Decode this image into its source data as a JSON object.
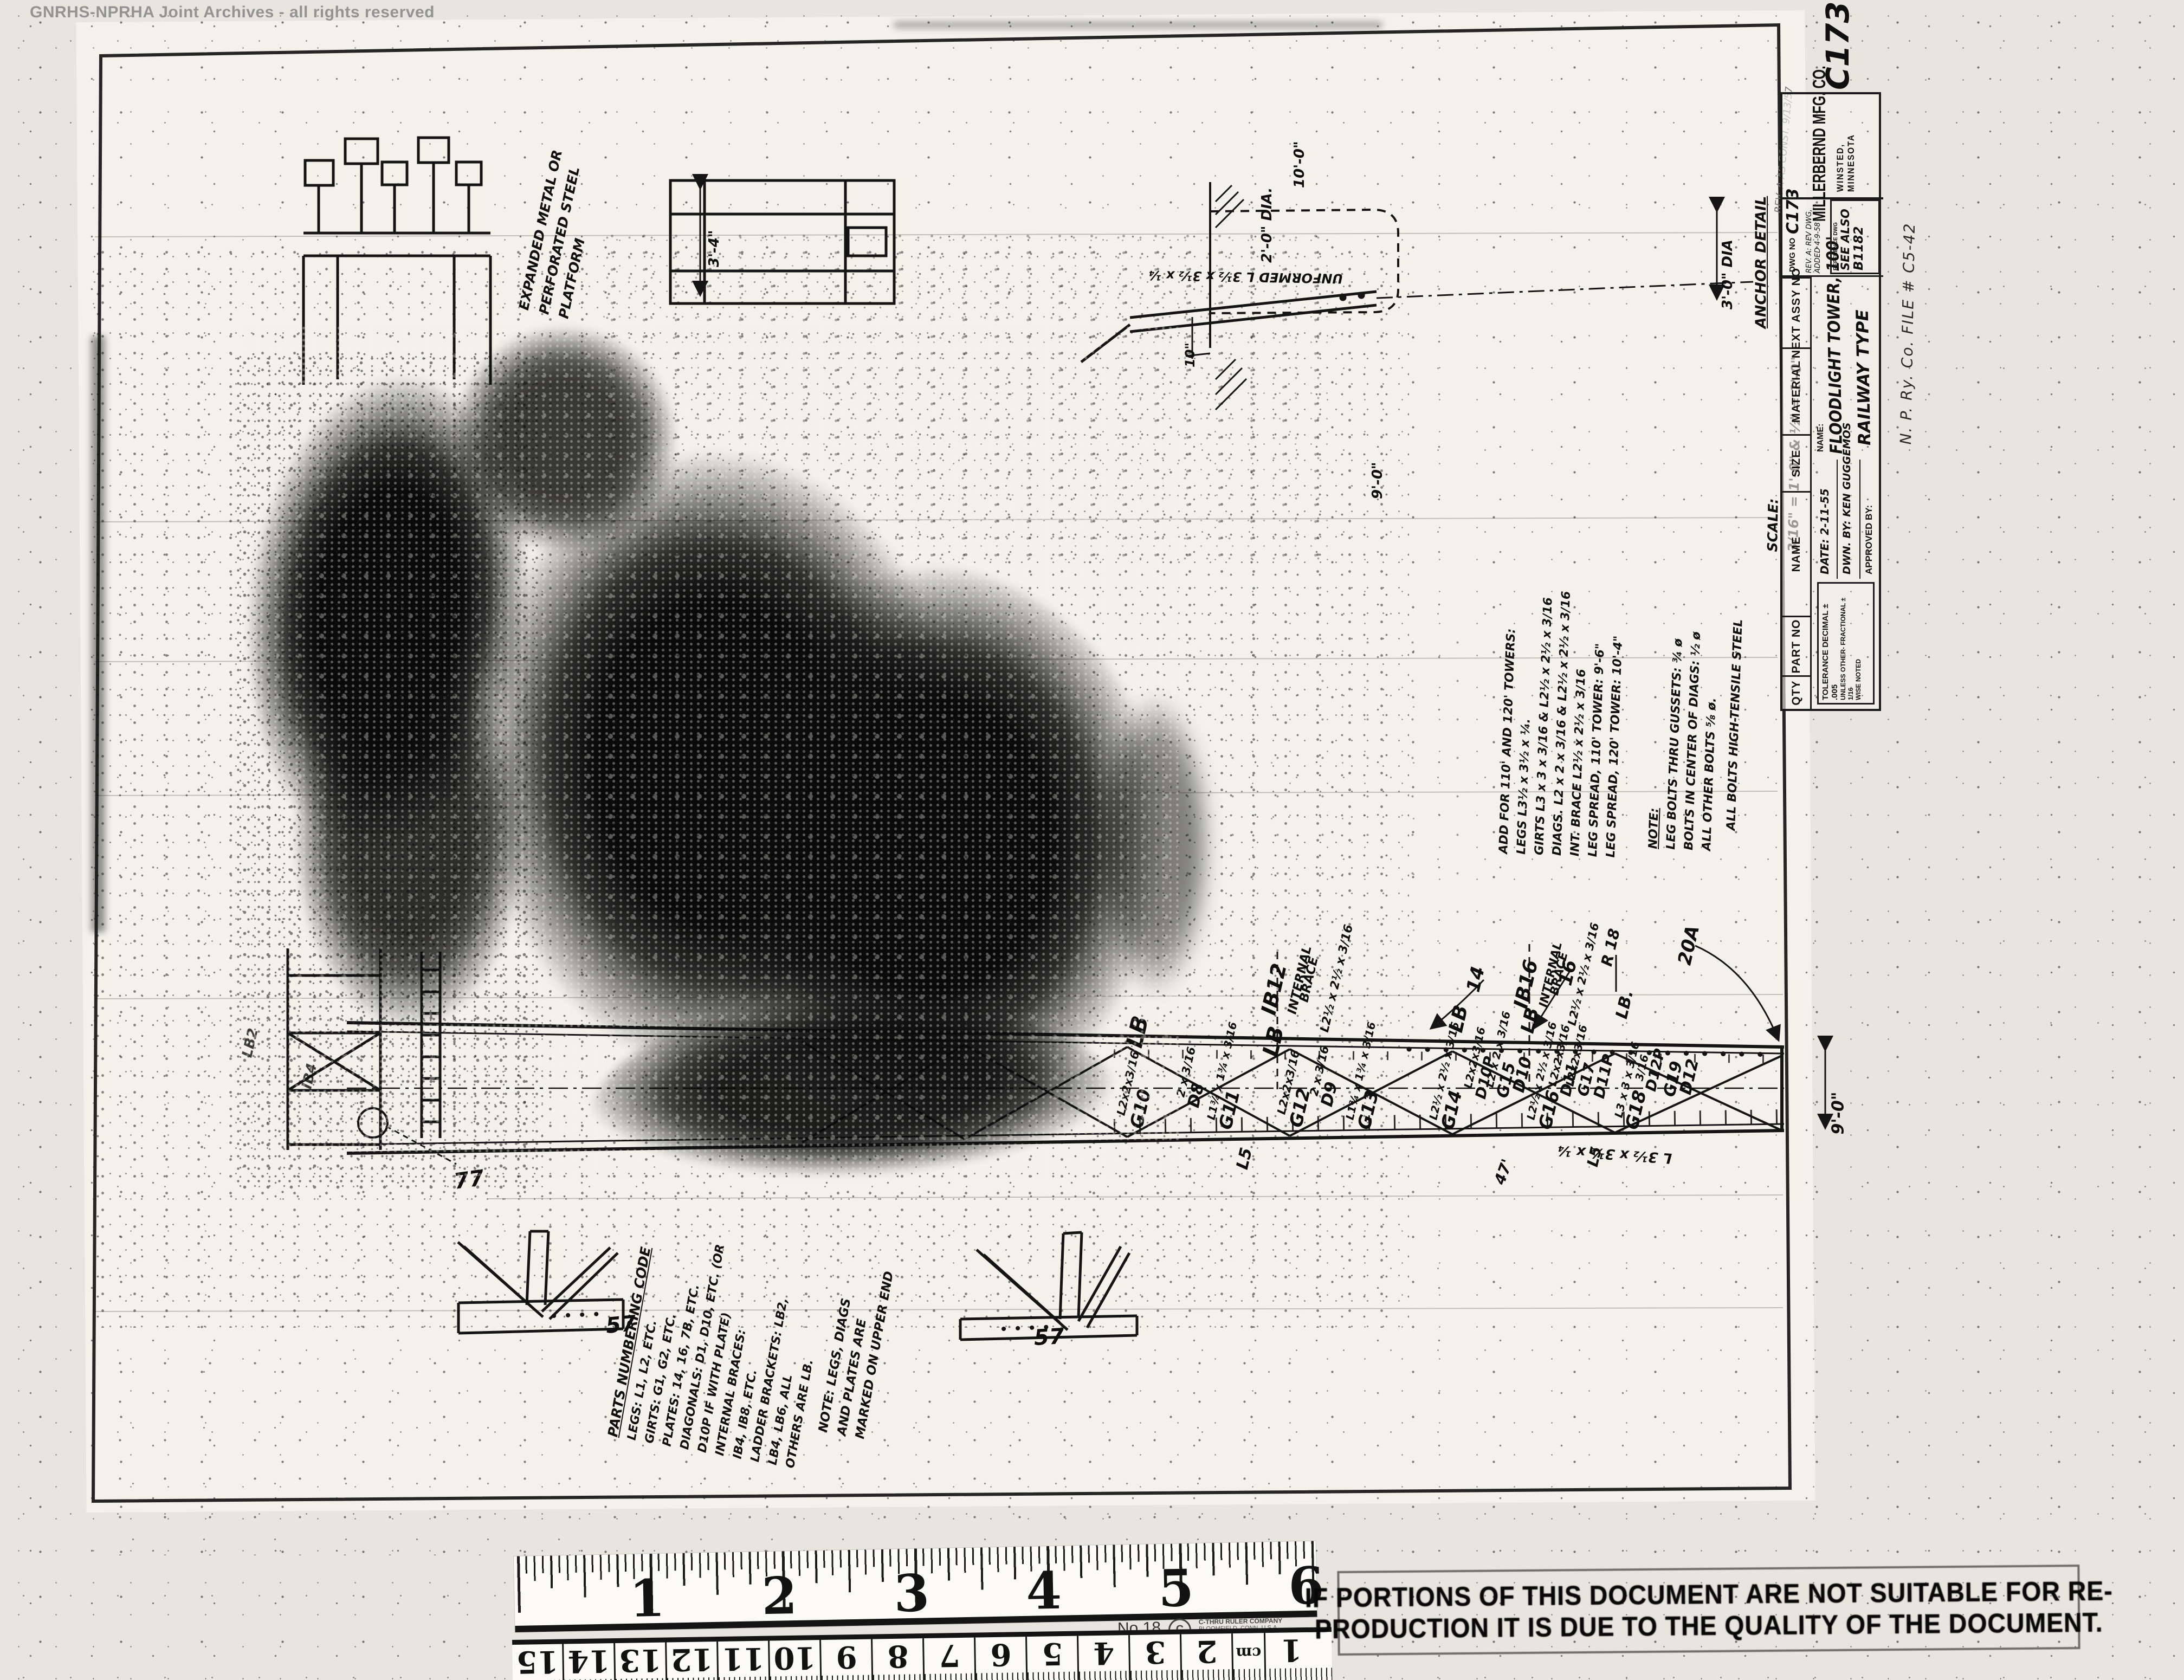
{
  "watermark": "GNRHS-NPRHA Joint Archives - all rights reserved",
  "title_block": {
    "sheet_no": "C173",
    "headers": {
      "qty": "QTY",
      "part_no": "PART NO",
      "name": "NAME",
      "size": "SIZE",
      "material": "MATERIAL",
      "next_assy": "NEXT ASSY NO"
    },
    "tolerance": {
      "l1": "TOLERANCE  DECIMAL ± .005",
      "l2": "UNLESS OTHER-  FRACTIONAL ± 1/16",
      "l3": "WISE NOTED"
    },
    "date": "DATE: 2-11-55",
    "drawn_by": "DWN. BY:  KEN GUGGEMOS",
    "approved_by": "APPROVED BY:",
    "name_label": "NAME:",
    "name_value_1": "FLOODLIGHT TOWER, 100'",
    "name_value_2": "RAILWAY TYPE",
    "dwg_no_label": "DWG NO",
    "dwg_no_value": "C173",
    "rev_note": "REV. A: REV DWG, ADDED 4-9-58",
    "reference_label": "REFERENCE DWG",
    "reference_value_1": "SEE ALSO",
    "reference_value_2": "B1182",
    "company": "MILLERBERND MFG. CO.",
    "company_city": "WINSTED, MINNESOTA",
    "file_note": "N. P. Ry. Co.    FILE  # C5-42",
    "scale_1": "SCALE:",
    "scale_2": "3/16\" = 1'-0\"  &  ½\" = 1'-0\""
  },
  "anchor_detail": {
    "title": "ANCHOR DETAIL",
    "rev_note": "REV. A  AS CONST. 9/13/57",
    "dim_dia_small": "2'-0\" DIA.",
    "dim_depth": "10'-0\"",
    "dim_stub": "10\"",
    "dim_spread": "9'-0\"",
    "dim_dia_big": "3'-0\" DIA",
    "leg_label": "UNFORMED  L 3½ x 3½ x ¼"
  },
  "platform": {
    "dim": "3'-4\"",
    "note_1": "EXPANDED METAL OR",
    "note_2": "PERFORATED STEEL",
    "note_3": "PLATFORM"
  },
  "notes_add": {
    "lines": [
      "ADD FOR 110' AND 120' TOWERS:",
      "LEGS  L3½ x 3½ x ¼.",
      "GIRTS  L3 x 3 x 3/16  &  L2½ x 2½ x 3/16",
      "DIAGS.  L2 x 2 x 3/16  &  L2½ x 2½ x 3/16",
      "INT. BRACE  L2½ x 2½ x 3/16",
      "LEG SPREAD, 110' TOWER: 9'-6\"",
      "LEG SPREAD, 120' TOWER: 10'-4\""
    ]
  },
  "notes_bolts": {
    "lines": [
      "NOTE:",
      "LEG BOLTS THRU GUSSETS: ¾ ø",
      "BOLTS IN CENTER OF DIAGS: ½ ø",
      "ALL OTHER BOLTS ⅝ ø."
    ]
  },
  "note_tensile": "ALL  BOLTS  HIGH-TENSILE  STEEL",
  "parts_code": {
    "lines": [
      "PARTS  NUMBERING  CODE",
      "LEGS: L1, L2, ETC.",
      "GIRTS: G1, G2, ETC.",
      "PLATES: 14, 16, 7B, ETC.",
      "DIAGONALS: D1, D10, ETC. (OR",
      "   D10P IF WITH PLATE)",
      "INTERNAL BRACES:",
      "   IB4, IB8, ETC.",
      "LADDER BRACKETS: LB2,",
      "   LB4, LB6, ALL",
      "   OTHERS ARE LB."
    ]
  },
  "marking_note": {
    "lines": [
      "NOTE: LEGS, DIAGS",
      "AND PLATES ARE",
      "MARKED ON UPPER END"
    ]
  },
  "part_labels": [
    "LB",
    "IB12",
    "INTERNAL",
    "BRACE",
    "L2½ x 2½ x 3/16",
    "LB",
    "G10",
    "L2x2x3/16",
    "D8",
    "2 x 3/16",
    "G11",
    "L1¾ x 1¾ x 3/16",
    "G12",
    "L2x2x3/16",
    "D9",
    "2 x 3/16",
    "G13",
    "L1¾ x 1¾ x 3/16",
    "LB",
    "14",
    "IB16",
    "INTERNAL",
    "BRACE",
    "L2½ x 2½ x 3/16",
    "LB",
    "16",
    "R 18",
    "LB.",
    "20A",
    "G14",
    "L2½ x 2½ x 3/16",
    "D10P",
    "L2x2x3/16",
    "G15",
    "L2 x 2 x 3/16",
    "D10",
    "G16",
    "L2½ x 2½ x 3/16",
    "D11",
    "L2x2x3/16",
    "G17",
    "L2x2x3/16",
    "D11P",
    "G18",
    "L3 x 3 x 3/16",
    "D12P",
    "3/16",
    "G19",
    "D12",
    "L5",
    "47'",
    "L5",
    "L 3½ x 3½ x ¼",
    "9'-0\"",
    "57",
    "57",
    "77",
    "LB2",
    "IB4"
  ],
  "ruler_in": {
    "n1": "1",
    "n2": "2",
    "n3": "3",
    "n4": "4",
    "n5": "5",
    "n6": "6",
    "model": "No.18",
    "brand_1": "C-THRU RULER COMPANY",
    "brand_2": "BLOOMFIELD, CONN. U.S.A."
  },
  "ruler_cm": {
    "values": [
      "15",
      "14",
      "13",
      "12",
      "11",
      "10",
      "9",
      "8",
      "7",
      "6",
      "5",
      "4",
      "3",
      "2"
    ],
    "unit": "cm",
    "last": "1"
  },
  "stamp": {
    "line1": "IF PORTIONS OF THIS DOCUMENT ARE NOT SUITABLE FOR RE-",
    "line2": "PRODUCTION IT IS DUE TO THE QUALITY OF THE DOCUMENT."
  }
}
